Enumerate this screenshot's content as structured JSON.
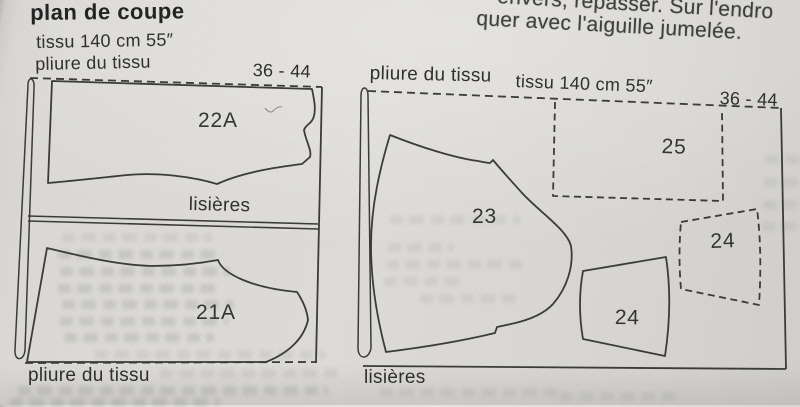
{
  "page": {
    "title": "plan de coupe",
    "clipped_instructions": {
      "line1": "envers, repasser. Sur l'endro",
      "line2": "quer avec l'aiguille jumelée."
    }
  },
  "left_layout": {
    "fabric": "tissu  140 cm 55″",
    "fold_top": "pliure du tissu",
    "sizes": "36 - 44",
    "selvages": "lisières",
    "fold_bottom": "pliure du tissu",
    "pieces": {
      "p22a": "22A",
      "p21a": "21A"
    }
  },
  "right_layout": {
    "fold": "pliure du tissu",
    "fabric": "tissu  140 cm 55″",
    "sizes": "36 - 44",
    "selvages": "lisières",
    "pieces": {
      "p23": "23",
      "p24_solid": "24",
      "p24_dashed": "24",
      "p25": "25"
    }
  },
  "colors": {
    "paper": "#d8d6d2",
    "line": "#3a3a38",
    "text": "#2e2e2e"
  }
}
